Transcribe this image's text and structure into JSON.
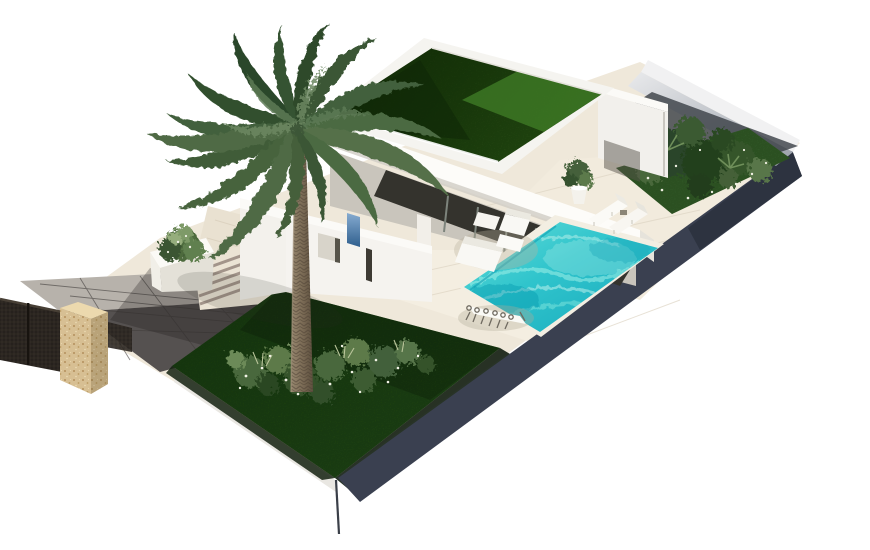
{
  "scene": {
    "description": "Aerial 3D render of a modern single-storey white villa on a floating plot: green grass flat roof, covered terrace with glass doors, turquoise swimming pool with sun loungers and outdoor furniture, large palm tree over a dark green lawn with flowering shrubs, tropical side garden, grey paved driveway with stone gate pillar and dark metal fence",
    "objects": [
      {
        "label": "villa-building"
      },
      {
        "label": "green-grass-roof"
      },
      {
        "label": "palm-tree"
      },
      {
        "label": "swimming-pool"
      },
      {
        "label": "sun-loungers"
      },
      {
        "label": "outdoor-sofa-set"
      },
      {
        "label": "dining-table-set"
      },
      {
        "label": "front-lawn"
      },
      {
        "label": "side-garden-bed"
      },
      {
        "label": "driveway"
      },
      {
        "label": "stone-gate-pillar"
      },
      {
        "label": "metal-fence"
      },
      {
        "label": "entry-steps"
      },
      {
        "label": "planter-box"
      },
      {
        "label": "potted-plant"
      }
    ]
  },
  "palette": {
    "background": "#ffffff",
    "terrace": "#efe8da",
    "terrace_sun": "#f4eee1",
    "pool_coping": "#f3eee2",
    "pool_deep": "#1fb5c4",
    "pool_light": "#7ee8e0",
    "lawn": "#234e18",
    "roof_grass_dark": "#16350f",
    "roof_grass_light": "#2f6420",
    "edge_band": "#3a4050",
    "drive_dark": "#555150",
    "drive_light": "#b7b2ab",
    "stone": "#d7bf93",
    "fence": "#26211d",
    "wall_white": "#f5f3ef",
    "wall_shadow": "#dcd8d0",
    "glass_dark": "#34332d",
    "foliage_dark": "#2c452a",
    "foliage_light": "#7c9468",
    "blue_panel": "#4f7cab"
  }
}
